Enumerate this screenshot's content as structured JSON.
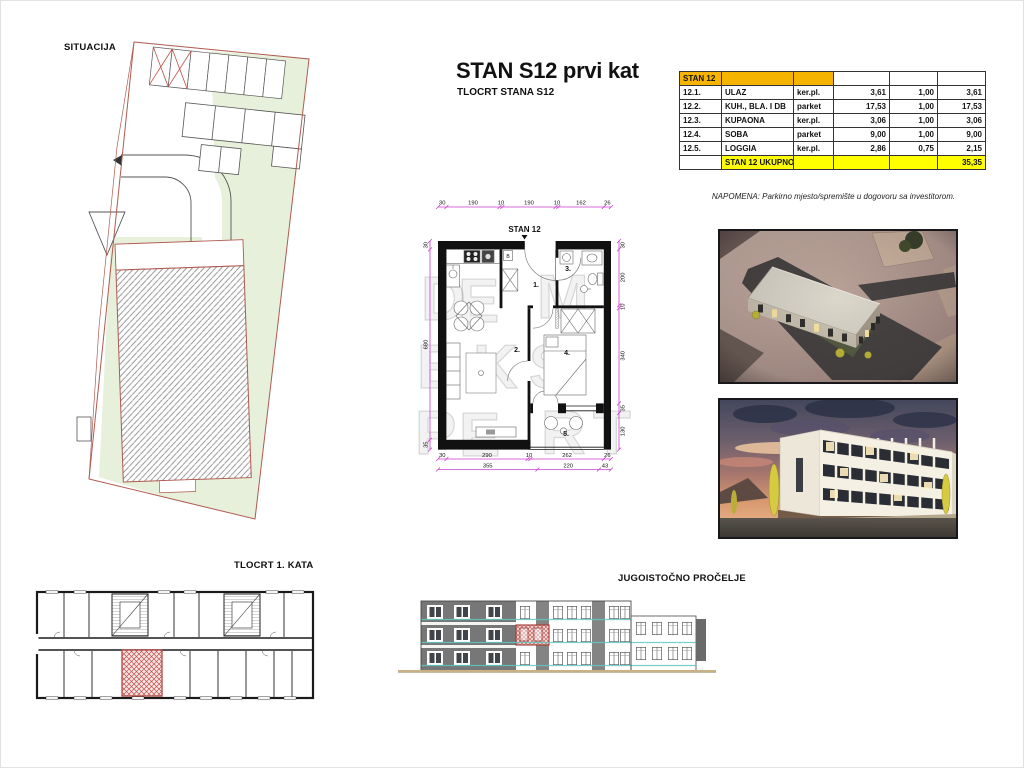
{
  "sheet": {
    "situacija_label": "SITUACIJA",
    "title": "STAN S12 prvi kat",
    "subtitle": "TLOCRT STANA S12",
    "napomena": "NAPOMENA: Parkirno mjesto/spremište u dogovoru sa investitorom.",
    "tlocrt_kata_label": "TLOCRT 1. KATA",
    "procelje_label": "JUGOISTOČNO PROČELJE"
  },
  "floor_plan": {
    "name_label": "STAN 12",
    "boiler_label": "B",
    "dims_top": [
      "30",
      "190",
      "10",
      "190",
      "10",
      "162",
      "26"
    ],
    "dims_left": [
      "30",
      "680",
      "35"
    ],
    "dims_right": [
      "30",
      "200",
      "10",
      "340",
      "35",
      "130"
    ],
    "dims_bottom_row1": [
      "30",
      "290",
      "10",
      "262",
      "26"
    ],
    "dims_bottom_row2": [
      "355",
      "220",
      "43"
    ],
    "rooms": [
      {
        "num": "1."
      },
      {
        "num": "2."
      },
      {
        "num": "3."
      },
      {
        "num": "4."
      },
      {
        "num": "5."
      }
    ]
  },
  "table": {
    "header": "STAN 12",
    "rows": [
      {
        "id": "12.1.",
        "name": "ULAZ",
        "floor": "ker.pl.",
        "area": "3,61",
        "coef": "1,00",
        "result": "3,61"
      },
      {
        "id": "12.2.",
        "name": "KUH., BLA. I DB",
        "floor": "parket",
        "area": "17,53",
        "coef": "1,00",
        "result": "17,53"
      },
      {
        "id": "12.3.",
        "name": "KUPAONA",
        "floor": "ker.pl.",
        "area": "3,06",
        "coef": "1,00",
        "result": "3,06"
      },
      {
        "id": "12.4.",
        "name": "SOBA",
        "floor": "parket",
        "area": "9,00",
        "coef": "1,00",
        "result": "9,00"
      },
      {
        "id": "12.5.",
        "name": "LOGGIA",
        "floor": "ker.pl.",
        "area": "2,86",
        "coef": "0,75",
        "result": "2,15"
      }
    ],
    "total_label": "STAN 12 UKUPNO:",
    "total_value": "35,35"
  },
  "watermark": {
    "letters": [
      {
        "ch": "D"
      },
      {
        "ch": "E"
      },
      {
        "ch": "M"
      },
      {
        "ch": "E"
      },
      {
        "ch": "K"
      },
      {
        "ch": "S"
      },
      {
        "ch": "P"
      },
      {
        "ch": "E"
      },
      {
        "ch": "R"
      },
      {
        "ch": "T"
      }
    ]
  },
  "colors": {
    "table_header_orange": "#F4B400",
    "table_total_yellow": "#FFFF00",
    "dimension_magenta": "#CC3ECC",
    "site_green": "#E6F0DA",
    "boundary_red": "#B05A50",
    "highlight_red": "#C0504D",
    "railing_teal": "#5FC8C0",
    "ground_tan": "#C9B186",
    "facade_gray": "#777777"
  }
}
